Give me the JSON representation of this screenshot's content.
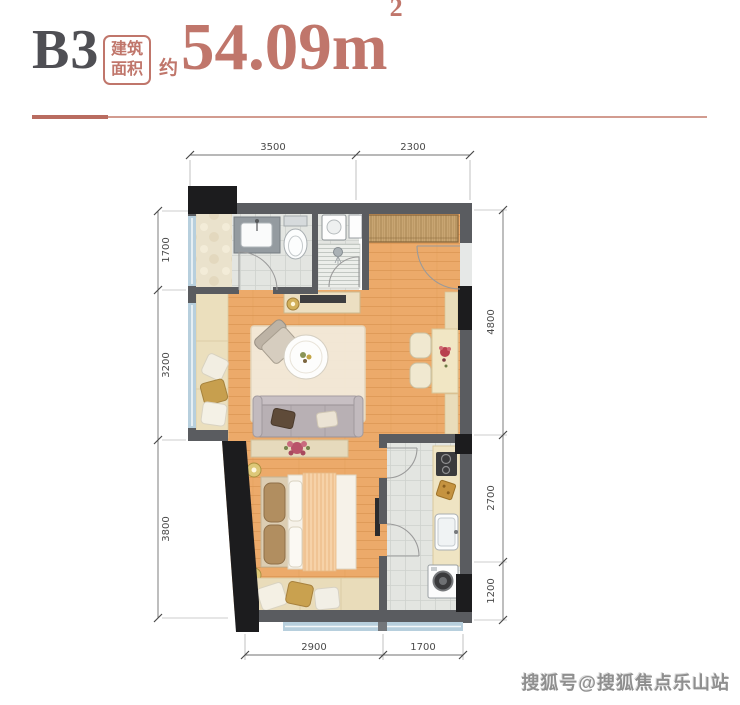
{
  "header": {
    "unit_label": "B3",
    "area_box": [
      "建筑",
      "面积"
    ],
    "approx": "约",
    "area_value": "54.09",
    "area_unit": "m",
    "area_sup": "2"
  },
  "dimensions": {
    "top": [
      "3500",
      "2300"
    ],
    "left": [
      "1700",
      "3200",
      "3800"
    ],
    "right": [
      "4800",
      "2700",
      "1200"
    ],
    "bottom": [
      "2900",
      "1700"
    ]
  },
  "watermark": "搜狐号@搜狐焦点乐山站",
  "colors": {
    "accent": "#c0766b",
    "accent_dark": "#b96c60",
    "title_dark": "#4f4f54",
    "wall_gray": "#5a5c60",
    "column_black": "#1c1c1e",
    "wood_floor": "#ecaa6a",
    "tile_floor": "#e3e5e1",
    "window_blue": "#b7cfdd",
    "seat_beige": "#e9dcba"
  }
}
